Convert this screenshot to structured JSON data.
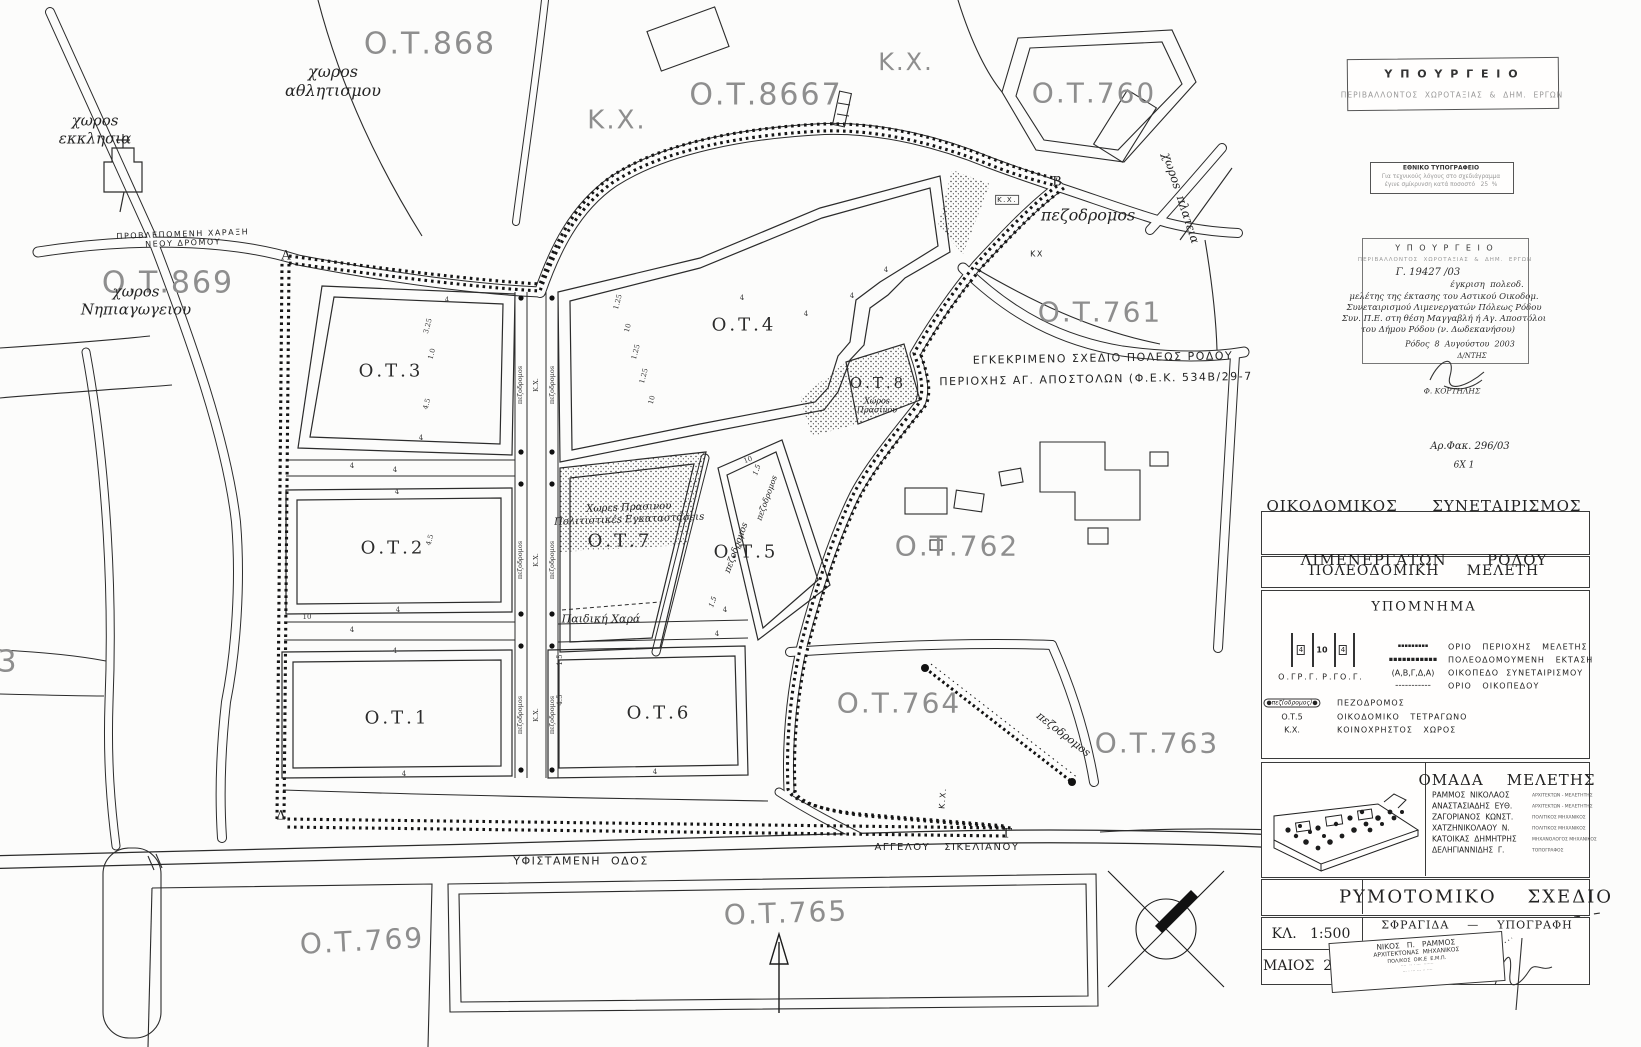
{
  "map": {
    "outer_labels": [
      {
        "id": "ot-868",
        "t": "Ο.Τ.868",
        "x": 430,
        "y": 44,
        "s": 30
      },
      {
        "id": "kx-top-left",
        "t": "Κ.Χ.",
        "x": 617,
        "y": 121,
        "s": 26
      },
      {
        "id": "ot-867",
        "t": "Ο.Τ.8667",
        "x": 766,
        "y": 95,
        "s": 30
      },
      {
        "id": "kx-top-right",
        "t": "Κ.Χ.",
        "x": 906,
        "y": 62,
        "s": 24
      },
      {
        "id": "ot-760",
        "t": "Ο.Τ.760",
        "x": 1094,
        "y": 93,
        "s": 28
      },
      {
        "id": "ot-869",
        "t": "Ο.Τ.869",
        "x": 168,
        "y": 283,
        "s": 30
      },
      {
        "id": "ot-761",
        "t": "Ο.Τ.761",
        "x": 1100,
        "y": 312,
        "s": 28
      },
      {
        "id": "ot-762",
        "t": "Ο.Τ.762",
        "x": 957,
        "y": 546,
        "s": 28
      },
      {
        "id": "ot-764",
        "t": "Ο.Τ.764",
        "x": 899,
        "y": 703,
        "s": 28
      },
      {
        "id": "ot-763",
        "t": "Ο.Τ.763",
        "x": 1157,
        "y": 743,
        "s": 28
      },
      {
        "id": "ot-765",
        "t": "Ο.Τ.765",
        "x": 786,
        "y": 913,
        "s": 28,
        "r": -2
      },
      {
        "id": "ot-769",
        "t": "Ο.Τ.769",
        "x": 362,
        "y": 941,
        "s": 28,
        "r": -3
      },
      {
        "id": "ot-left-3",
        "t": "3",
        "x": 8,
        "y": 662,
        "s": 30
      }
    ],
    "inner_labels": [
      {
        "id": "ot-3",
        "t": "Ο.Τ.3",
        "x": 391,
        "y": 371
      },
      {
        "id": "ot-4",
        "t": "Ο.Τ.4",
        "x": 744,
        "y": 325
      },
      {
        "id": "ot-2",
        "t": "Ο.Τ.2",
        "x": 393,
        "y": 548
      },
      {
        "id": "ot-7",
        "t": "Ο.Τ.7",
        "x": 620,
        "y": 541
      },
      {
        "id": "ot-5",
        "t": "Ο.Τ.5",
        "x": 746,
        "y": 552
      },
      {
        "id": "ot-8",
        "t": "Ο.Τ.8",
        "x": 878,
        "y": 384,
        "s": 15
      },
      {
        "id": "ot-1",
        "t": "Ο.Τ.1",
        "x": 397,
        "y": 718
      },
      {
        "id": "ot-6",
        "t": "Ο.Τ.6",
        "x": 659,
        "y": 713
      }
    ],
    "hand_labels": [
      {
        "id": "area-church",
        "t": "χωροs\nεκκλησια",
        "x": 95,
        "y": 130,
        "s": 15
      },
      {
        "id": "area-sports",
        "t": "χωροs\nαθλητισμου",
        "x": 333,
        "y": 82,
        "s": 16
      },
      {
        "id": "area-kindergarten",
        "t": "χωροs\nΝηπιαγωγειου",
        "x": 136,
        "y": 301,
        "s": 15
      },
      {
        "id": "new-road-note",
        "t": "ΠΡΟΒΛΕΠΟΜΕΝΗ ΧΑΡΑΞΗ\nΝΕΟΥ ΔΡΟΜΟΥ",
        "x": 183,
        "y": 239,
        "s": 8,
        "r": -2,
        "f": "cap"
      },
      {
        "id": "pedestrian-ne",
        "t": "πεζοδρομοs",
        "x": 1088,
        "y": 216,
        "s": 16
      },
      {
        "id": "area-plateia",
        "t": "χωροs  πλατεια",
        "x": 1181,
        "y": 198,
        "s": 12,
        "r": 72
      },
      {
        "id": "ot7-use",
        "t": "Χωρεs Πρασινου\nΠολιτιστικέs Εγκαταστάσειs",
        "x": 629,
        "y": 514,
        "s": 10,
        "r": -2
      },
      {
        "id": "ot7-playground",
        "t": "Παιδική Χαρά",
        "x": 601,
        "y": 620,
        "s": 11
      },
      {
        "id": "ot8-use",
        "t": "Χώροs\nΠρασίνου",
        "x": 877,
        "y": 406,
        "s": 8
      },
      {
        "id": "street-sikelianou",
        "t": "ΑΓΓΕΛΟΥ   ΣΙΚΕΛΙΑΝΟΥ",
        "x": 947,
        "y": 848,
        "s": 10,
        "f": "cap"
      },
      {
        "id": "street-yfistameni",
        "t": "ΥΦΙΣΤΑΜΕΝΗ  ΟΔΟΣ",
        "x": 581,
        "y": 862,
        "s": 11,
        "f": "cap"
      },
      {
        "id": "approved-plan-line1",
        "t": "ΕΓΚΕΚΡΙΜΕΝΟ ΣΧΕΔΙΟ ΠΟΛΕΩΣ ΡΟΔΟΥ",
        "x": 1103,
        "y": 359,
        "s": 11,
        "r": -1,
        "f": "cap"
      },
      {
        "id": "approved-plan-line2",
        "t": "ΠΕΡΙΟΧΗΣ ΑΓ. ΑΠΟΣΤΟΛΩΝ (Φ.Ε.Κ. 534Β/29-7",
        "x": 1096,
        "y": 380,
        "s": 11,
        "r": -1,
        "f": "cap"
      },
      {
        "id": "file-number",
        "t": "Αρ.Φακ. 296/03",
        "x": 1470,
        "y": 447,
        "s": 10
      },
      {
        "id": "file-number-2",
        "t": "6Χ 1",
        "x": 1464,
        "y": 466,
        "s": 9
      },
      {
        "id": "pedestrian-764",
        "t": "πεζοδρομοs",
        "x": 1063,
        "y": 735,
        "s": 11,
        "r": 38
      },
      {
        "id": "pedestrian-ot5",
        "t": "πεζοδρομοs",
        "x": 737,
        "y": 548,
        "s": 9,
        "r": -70
      },
      {
        "id": "pedestrian-ot5-b",
        "t": "πεζοδρομοs",
        "x": 767,
        "y": 498,
        "s": 8,
        "r": -70
      },
      {
        "id": "kx-near-b1",
        "t": "Κ.Χ.",
        "x": 1007,
        "y": 200,
        "s": 7,
        "f": "cap",
        "box": true
      },
      {
        "id": "kx-near-b2",
        "t": "ΚΧ",
        "x": 1037,
        "y": 254,
        "s": 8,
        "f": "cap"
      },
      {
        "id": "kx-bottom",
        "t": "Κ.Χ.",
        "x": 943,
        "y": 798,
        "s": 8,
        "r": -85,
        "f": "cap"
      },
      {
        "id": "dim-15a",
        "t": "1.5",
        "x": 757,
        "y": 470,
        "s": 7,
        "r": -70
      },
      {
        "id": "dim-15b",
        "t": "1.5",
        "x": 713,
        "y": 602,
        "s": 7,
        "r": -70
      }
    ],
    "vertices": [
      {
        "id": "vertex-a",
        "t": "Α",
        "x": 286,
        "y": 256
      },
      {
        "id": "vertex-b",
        "t": "Β",
        "x": 1057,
        "y": 182
      },
      {
        "id": "vertex-g",
        "t": "Γ",
        "x": 1008,
        "y": 834
      },
      {
        "id": "vertex-d",
        "t": "Δ",
        "x": 281,
        "y": 816
      }
    ],
    "strip_labels": [
      {
        "t": "πεζοδρομοs",
        "x": 521,
        "y": 385
      },
      {
        "t": "Κ.Χ.",
        "x": 537,
        "y": 385
      },
      {
        "t": "πεζοδρομοs",
        "x": 553,
        "y": 385
      },
      {
        "t": "πεζοδρομοs",
        "x": 521,
        "y": 560
      },
      {
        "t": "Κ.Χ.",
        "x": 537,
        "y": 560
      },
      {
        "t": "πεζοδρομοs",
        "x": 553,
        "y": 560
      },
      {
        "t": "πεζοδρομοs",
        "x": 521,
        "y": 715
      },
      {
        "t": "Κ.Χ.",
        "x": 537,
        "y": 715
      },
      {
        "t": "πεζοδρομοs",
        "x": 553,
        "y": 715
      }
    ],
    "dims": [
      {
        "t": "4",
        "x": 447,
        "y": 300
      },
      {
        "t": "3.25",
        "x": 428,
        "y": 326,
        "r": -75
      },
      {
        "t": "1.0",
        "x": 432,
        "y": 354,
        "r": -75
      },
      {
        "t": "4.5",
        "x": 427,
        "y": 404,
        "r": -75
      },
      {
        "t": "4",
        "x": 421,
        "y": 438
      },
      {
        "t": "4",
        "x": 395,
        "y": 470
      },
      {
        "t": "4",
        "x": 397,
        "y": 492
      },
      {
        "t": "4.5",
        "x": 430,
        "y": 540,
        "r": -75
      },
      {
        "t": "4",
        "x": 398,
        "y": 610
      },
      {
        "t": "4",
        "x": 395,
        "y": 651
      },
      {
        "t": "4",
        "x": 404,
        "y": 774
      },
      {
        "t": "10",
        "x": 307,
        "y": 617
      },
      {
        "t": "1.25",
        "x": 618,
        "y": 302,
        "r": -75
      },
      {
        "t": "10",
        "x": 628,
        "y": 328,
        "r": -75
      },
      {
        "t": "1.25",
        "x": 636,
        "y": 352,
        "r": -75
      },
      {
        "t": "1.25",
        "x": 644,
        "y": 376,
        "r": -75
      },
      {
        "t": "10",
        "x": 652,
        "y": 400,
        "r": -75
      },
      {
        "t": "4",
        "x": 742,
        "y": 298
      },
      {
        "t": "4",
        "x": 806,
        "y": 314
      },
      {
        "t": "4",
        "x": 852,
        "y": 296
      },
      {
        "t": "4",
        "x": 886,
        "y": 270
      },
      {
        "t": "4",
        "x": 725,
        "y": 610
      },
      {
        "t": "4",
        "x": 655,
        "y": 772
      },
      {
        "t": "4.5",
        "x": 560,
        "y": 700,
        "r": -90
      },
      {
        "t": "1.5",
        "x": 560,
        "y": 660,
        "r": -90
      },
      {
        "t": "4",
        "x": 717,
        "y": 634
      },
      {
        "t": "10",
        "x": 748,
        "y": 460,
        "r": -20
      },
      {
        "t": "4",
        "x": 352,
        "y": 466
      },
      {
        "t": "4",
        "x": 352,
        "y": 630
      }
    ]
  },
  "stamps": {
    "ministry": {
      "line1": "Υ Π Ο Υ Ρ Γ Ε Ι Ο",
      "line2": "ΠΕΡΙΒΑΛΛΟΝΤΟΣ  ΧΩΡΟΤΑΞΙΑΣ  &  ΔΗΜ.  ΕΡΓΩΝ"
    },
    "printing_office": {
      "title": "ΕΘΝΙΚΟ ΤΥΠΟΓΡΑΦΕΙΟ",
      "body1": "Για τεχνικούς λόγους στο σχεδιάγραμμα",
      "body2": "έγινε σμίκρυνση κατά ποσοστό   25  %"
    },
    "approval": {
      "lines": [
        {
          "t": "Υ Π Ο Υ Ρ Γ Ε Ι Ο",
          "x": 1445,
          "y": 248,
          "s": 8,
          "c": "typed"
        },
        {
          "t": "ΠΕΡΙΒΑΛΛΟΝΤΟΣ  ΧΩΡΟΤΑΞΙΑΣ  &  ΔΗΜ.  ΕΡΓΩΝ",
          "x": 1445,
          "y": 260,
          "s": 5.5,
          "c": "faded"
        },
        {
          "t": "Γ. 19427 /03",
          "x": 1428,
          "y": 273,
          "s": 10,
          "c": "hand2"
        },
        {
          "t": "έγκριση  πολεοδ.",
          "x": 1487,
          "y": 285,
          "s": 8.5,
          "c": "hand2"
        },
        {
          "t": "μελέτης της έκτασης του Αστικού Οικοδομ.",
          "x": 1444,
          "y": 297,
          "s": 8.5,
          "c": "hand2"
        },
        {
          "t": "Συνεταιρισμού Λιμενεργατών Πόλεως Ρόδου",
          "x": 1444,
          "y": 308,
          "s": 8.5,
          "c": "hand2"
        },
        {
          "t": "Συν. Π.Ε. στη θέση Μαγγαβλή ή Αγ. Αποστόλοι",
          "x": 1444,
          "y": 319,
          "s": 8.5,
          "c": "hand2"
        },
        {
          "t": "του Δήμου Ρόδου (ν. Δωδεκανήσου)",
          "x": 1438,
          "y": 330,
          "s": 8.5,
          "c": "hand2"
        },
        {
          "t": "Ρόδος  8  Αυγούστου  2003",
          "x": 1460,
          "y": 344,
          "s": 8,
          "c": "hand2"
        },
        {
          "t": "Δ/ΝΤΗΣ",
          "x": 1472,
          "y": 356,
          "s": 7,
          "c": "hand2"
        },
        {
          "t": "Φ. ΚΟΡΤΗΛΗΣ",
          "x": 1452,
          "y": 392,
          "s": 7.5,
          "c": "hand2"
        }
      ]
    }
  },
  "titleblock": {
    "coop_line1": "ΟΙΚΟΔΟΜΙΚΟΣ      ΣΥΝΕΤΑΙΡΙΣΜΟΣ",
    "coop_line2": "ΛΙΜΕΝΕΡΓΑΤΩΝ       ΡΟΔΟΥ",
    "study_title": "ΠΟΛΕΟΔΟΜΙΚΗ     ΜΕΛΕΤΗ",
    "legend_title": "ΥΠΟΜΝΗΜΑ",
    "section_numbers": [
      "4",
      "10",
      "4"
    ],
    "section_labels": [
      "Ο.ΓΡ.Γ.",
      "Ρ.ΓΟ.Γ."
    ],
    "legend_items": [
      {
        "sym": "▪▪▪▪▪▪▪▪▪",
        "cls": "symdots1",
        "label": "ΟΡΙΟ   ΠΕΡΙΟΧΗΣ   ΜΕΛΕΤΗΣ"
      },
      {
        "sym": "▪▪▪▪▪▪▪▪▪▪▪",
        "cls": "symdots2",
        "label": "ΠΟΛΕΟΔΟΜΟΥΜΕΝΗ   ΕΚΤΑΣΗ"
      },
      {
        "sym": "(Α,Β,Γ,Δ,Α)",
        "cls": "symtext",
        "label": "ΟΙΚΟΠΕΔΟ  ΣΥΝΕΤΑΙΡΙΣΜΟΥ"
      },
      {
        "sym": "-----------",
        "cls": "symdash",
        "label": "ΟΡΙΟ   ΟΙΚΟΠΕΔΟΥ"
      }
    ],
    "legend_items2": [
      {
        "sym": "●πεζ(οδρομος)●",
        "cls": "symcapsule",
        "label": "ΠΕΖΟΔΡΟΜΟΣ"
      },
      {
        "sym": "Ο.Τ.5",
        "cls": "symtext",
        "label": "ΟΙΚΟΔΟΜΙΚΟ   ΤΕΤΡΑΓΩΝΟ"
      },
      {
        "sym": "Κ.Χ.",
        "cls": "symtext",
        "label": "ΚΟΙΝΟΧΡΗΣΤΟΣ   ΧΩΡΟΣ"
      }
    ],
    "team_title": "ΟΜΑΔΑ    ΜΕΛΕΤΗΣ",
    "team": [
      {
        "name": "ΡΑΜΜΟΣ  ΝΙΚΟΛΑΟΣ",
        "role": "ΑΡΧΙΤΕΚΤΩΝ - ΜΕΛΕΤΗΤΗΣ"
      },
      {
        "name": "ΑΝΑΣΤΑΣΙΑΔΗΣ  ΕΥΘ.",
        "role": "ΑΡΧΙΤΕΚΤΩΝ - ΜΕΛΕΤΗΤΗΣ"
      },
      {
        "name": "ΖΑΓΟΡΙΑΝΟΣ  ΚΩΝΣΤ.",
        "role": "ΠΟΛΙΤΙΚΟΣ ΜΗΧΑΝΙΚΟΣ"
      },
      {
        "name": "ΧΑΤΖΗΝΙΚΟΛΑΟΥ  Ν.",
        "role": "ΠΟΛΙΤΙΚΟΣ ΜΗΧΑΝΙΚΟΣ"
      },
      {
        "name": "ΚΑΤΟΙΚΑΣ  ΔΗΜΗΤΡΗΣ",
        "role": "ΜΗΧΑΝΟΛΟΓΟΣ ΜΗΧΑΝΙΚΟΣ"
      },
      {
        "name": "ΔΕΛΗΓΙΑΝΝΙΔΗΣ  Γ.",
        "role": "ΤΟΠΟΓΡΑΦΟΣ"
      }
    ],
    "plan_title": "ΡΥΜΟΤΟΜΙΚΟ    ΣΧΕΔΙΟ",
    "scale": "ΚΛ.   1:500",
    "date": "ΜΑΙΟΣ  2001",
    "stamp_sig": "ΣΦΡΑΓΙΔΑ    —    ΥΠΟΓΡΑΦΗ",
    "arch_stamp_lines": [
      "ΝΙΚΟΣ   Π.   ΡΑΜΜΟΣ",
      "ΑΡΧΙΤΕΚΤΟΝΑΣ  ΜΗΧΑΝΙΚΟΣ",
      "ΠΟΛ/ΚΟΣ  ΟΙΚ.Ε  Ε.Μ.Π.",
      "····  ·· · ···  ·······",
      "··· · ··· ··· ·· ····"
    ]
  }
}
